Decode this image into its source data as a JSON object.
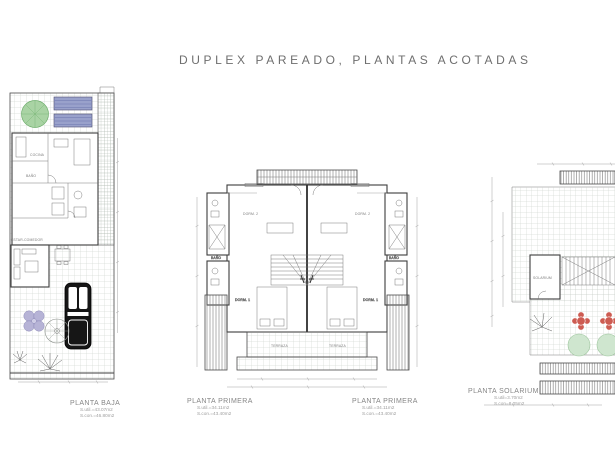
{
  "title": "DUPLEX PAREADO, PLANTAS ACOTADAS",
  "labels": {
    "baja": {
      "name": "PLANTA BAJA",
      "util": "S.util.=43.07m2",
      "con": "S.con.=46.80m2"
    },
    "primera_left": {
      "name": "PLANTA PRIMERA",
      "util": "S.util.=34.11m2",
      "con": "S.con.=43.40m2"
    },
    "primera_right": {
      "name": "PLANTA PRIMERA",
      "util": "S.util.=34.11m2",
      "con": "S.con.=43.40m2"
    },
    "solarium": {
      "name": "PLANTA SOLARIUM",
      "util": "S.util=3.70m2",
      "con": "S.con=8.05m2"
    }
  },
  "rooms": {
    "cocina": "COCINA",
    "estar": "ESTAR-COMEDOR",
    "dorm1": "DORM. 1",
    "dorm2": "DORM. 2",
    "bano": "BAÑO",
    "terraza": "TERRAZA",
    "solarium": "SOLARIUM"
  },
  "colors": {
    "wall_line": "#3d3d3d",
    "grid_line": "#c6cdc6",
    "dimension_line": "#9b9b9b",
    "tree_green": "#a9d3a4",
    "panel_blue": "#99a1cb",
    "car_black": "#161616",
    "flower_purple": "#b6b3d6",
    "table_red": "#cd5c52",
    "bush_green": "#cfe6cf",
    "title_gray": "#6e6e6e"
  }
}
